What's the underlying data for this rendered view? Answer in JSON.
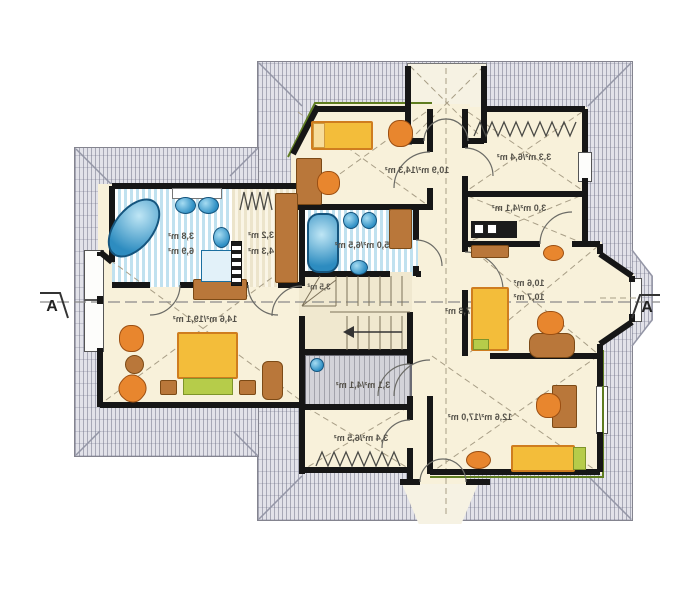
{
  "plan": {
    "type": "attic-floor-plan",
    "section_marker": {
      "left_label": "A",
      "right_label": "A"
    },
    "rooms": {
      "top_bedroom": {
        "label": "10,9 m²/14,3 m²"
      },
      "wardrobe_top": {
        "label": "3,3 m²/6,4 m²"
      },
      "utility": {
        "label": "3,0 m²/4,1 m²"
      },
      "right_room": {
        "line1": "10,6 m²",
        "line2": "10,7 m²"
      },
      "bottom_right_room": {
        "label": "12,6 m²/17,0 m²"
      },
      "hall": {
        "label": "7,8 m²"
      },
      "stairs": {
        "label": "3,5 m²"
      },
      "bath_center": {
        "label": "5,0 m²/6,5 m²"
      },
      "bath_left": {
        "line1": "3,8 m²",
        "line2": "6,9 m²"
      },
      "small_left": {
        "line1": "3,2 m²",
        "line2": "4,3 m²"
      },
      "master_bedroom": {
        "label": "14,6 m²/19,1 m²"
      },
      "storage": {
        "label": "3,1 m²/4,1 m²"
      },
      "wardrobe_bottom": {
        "label": "3,4 m²/6,5 m²"
      }
    },
    "colors": {
      "floor_cream": "#f8f1da",
      "roof_hatch": "#e2e2e9",
      "bath_blue": "#2d8cc0",
      "furniture_yellow": "#f3bd3a",
      "furniture_orange": "#e8862e",
      "furniture_wood": "#b9773a",
      "accent_green": "#b6cc4a",
      "wall_black": "#161616"
    }
  }
}
